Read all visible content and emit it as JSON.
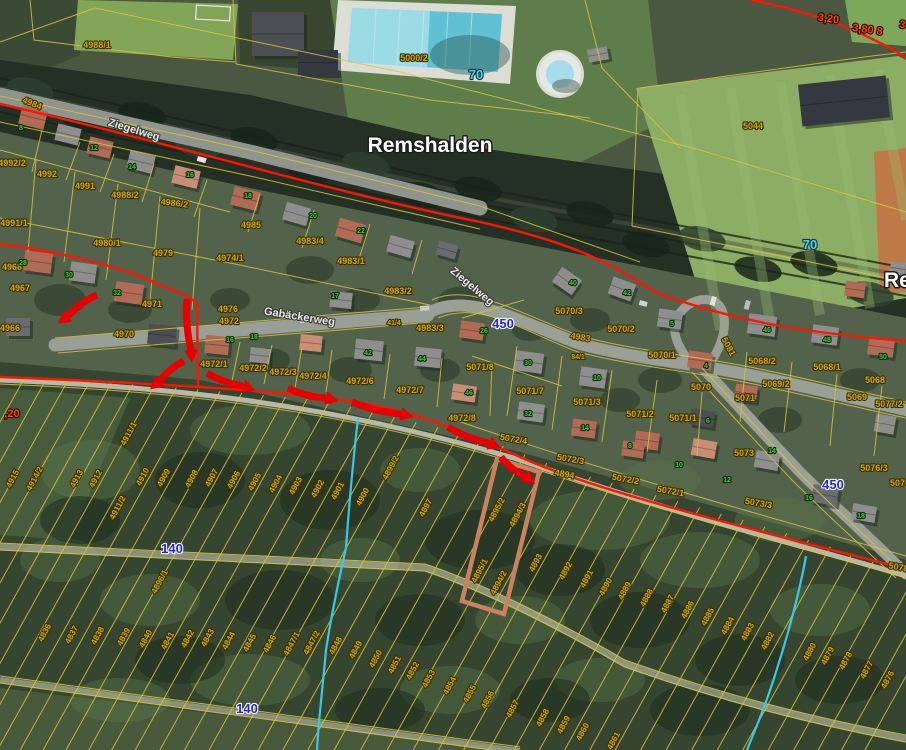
{
  "map": {
    "place_labels": [
      [
        "Remshalden",
        430,
        152,
        "middle"
      ],
      [
        "Re",
        884,
        287,
        "start"
      ]
    ],
    "street_labels": [
      [
        "Ziegelweg",
        133,
        133,
        17
      ],
      [
        "Ziegelweg",
        470,
        289,
        40
      ],
      [
        "Gabäckerweg",
        299,
        320,
        9
      ]
    ],
    "route_labels": [
      [
        "70",
        476,
        79,
        "cyan"
      ],
      [
        "70",
        810,
        249,
        "cyan"
      ],
      [
        "450",
        503,
        328,
        "blue"
      ],
      [
        "450",
        833,
        489,
        "blue"
      ],
      [
        "140",
        172,
        553,
        "blue"
      ],
      [
        "140",
        247,
        713,
        "blue"
      ]
    ],
    "measure_labels": [
      [
        "3,20",
        828,
        22,
        8
      ],
      [
        "3,80 8",
        867,
        33,
        8
      ],
      [
        "3",
        902,
        28,
        8
      ],
      [
        ",20",
        12,
        417,
        0
      ]
    ],
    "parcel_labels": [
      [
        "4988/1",
        97,
        48,
        0
      ],
      [
        "5000/2",
        414,
        61,
        0
      ],
      [
        "5044",
        753,
        129,
        0
      ],
      [
        "4984",
        31,
        106,
        22
      ],
      [
        "4992/2",
        12,
        166,
        0
      ],
      [
        "4992",
        47,
        177,
        0
      ],
      [
        "4991",
        85,
        189,
        0
      ],
      [
        "4988/2",
        125,
        198,
        0
      ],
      [
        "4986/2",
        174,
        206,
        7
      ],
      [
        "4985",
        251,
        228,
        0
      ],
      [
        "4983/4",
        310,
        244,
        0
      ],
      [
        "4983/1",
        351,
        264,
        0
      ],
      [
        "4983/2",
        398,
        294,
        0
      ],
      [
        "4983/3",
        430,
        331,
        0
      ],
      [
        "4991/1",
        14,
        226,
        0
      ],
      [
        "4980/1",
        107,
        246,
        0
      ],
      [
        "4979",
        163,
        256,
        0
      ],
      [
        "4974/1",
        230,
        261,
        0
      ],
      [
        "4968",
        12,
        270,
        0
      ],
      [
        "4967",
        20,
        291,
        0
      ],
      [
        "4966",
        10,
        331,
        0
      ],
      [
        "4971",
        152,
        307,
        0
      ],
      [
        "4970",
        124,
        337,
        0
      ],
      [
        "4976",
        228,
        312,
        0
      ],
      [
        "4972",
        229,
        324,
        0
      ],
      [
        "41/4",
        394,
        325,
        0
      ],
      [
        "4972/1",
        214,
        367,
        0
      ],
      [
        "4972/2",
        253,
        371,
        0
      ],
      [
        "4972/3",
        283,
        375,
        0
      ],
      [
        "4972/4",
        313,
        379,
        0
      ],
      [
        "4972/6",
        360,
        384,
        0
      ],
      [
        "4972/7",
        410,
        393,
        0
      ],
      [
        "4972/8",
        462,
        421,
        0
      ],
      [
        "5071/8",
        480,
        370,
        0
      ],
      [
        "5071/7",
        530,
        394,
        0
      ],
      [
        "5071/3",
        587,
        405,
        0
      ],
      [
        "5071/2",
        640,
        417,
        0
      ],
      [
        "5071/1",
        683,
        421,
        0
      ],
      [
        "5070/3",
        569,
        314,
        0
      ],
      [
        "5070/2",
        621,
        332,
        0
      ],
      [
        "5070/1",
        662,
        358,
        0
      ],
      [
        "4983",
        580,
        340,
        10
      ],
      [
        "84/1",
        578,
        359,
        0
      ],
      [
        "5070",
        701,
        390,
        0
      ],
      [
        "5071",
        745,
        401,
        0
      ],
      [
        "5081",
        726,
        348,
        62
      ],
      [
        "5068/2",
        762,
        364,
        0
      ],
      [
        "5068/1",
        827,
        370,
        0
      ],
      [
        "5068",
        875,
        383,
        0
      ],
      [
        "5069/2",
        776,
        387,
        0
      ],
      [
        "5069",
        857,
        400,
        0
      ],
      [
        "5077/2",
        889,
        407,
        0
      ],
      [
        "5076/3",
        874,
        471,
        0
      ],
      [
        "5076",
        900,
        486,
        0
      ],
      [
        "5072/4",
        513,
        442,
        10
      ],
      [
        "5072/3",
        570,
        462,
        10
      ],
      [
        "5072/2",
        625,
        482,
        10
      ],
      [
        "5072/1",
        670,
        494,
        10
      ],
      [
        "5073/3",
        758,
        506,
        10
      ],
      [
        "5073",
        744,
        456,
        0
      ],
      [
        "4894",
        564,
        477,
        10
      ],
      [
        "5078",
        898,
        570,
        10
      ],
      [
        "4915",
        15,
        480,
        -62
      ],
      [
        "4914/2",
        37,
        480,
        -62
      ],
      [
        "4913",
        79,
        480,
        -62
      ],
      [
        "4912",
        98,
        480,
        -62
      ],
      [
        "4911/1",
        131,
        435,
        -62
      ],
      [
        "4911/2",
        120,
        509,
        -62
      ],
      [
        "4910",
        145,
        478,
        -62
      ],
      [
        "4909",
        166,
        479,
        -62
      ],
      [
        "4908",
        194,
        480,
        -62
      ],
      [
        "4907",
        214,
        479,
        -62
      ],
      [
        "4906",
        236,
        481,
        -62
      ],
      [
        "4905",
        257,
        483,
        -62
      ],
      [
        "4904",
        278,
        485,
        -62
      ],
      [
        "4903",
        298,
        487,
        -62
      ],
      [
        "4902",
        320,
        490,
        -62
      ],
      [
        "4901",
        340,
        492,
        -62
      ],
      [
        "4900",
        365,
        498,
        -62
      ],
      [
        "4899/2",
        393,
        469,
        -62
      ],
      [
        "4897",
        428,
        509,
        -62
      ],
      [
        "4895/2",
        499,
        511,
        -62
      ],
      [
        "4894/3",
        520,
        516,
        -62
      ],
      [
        "4895/1",
        482,
        572,
        -62
      ],
      [
        "4894/2",
        501,
        584,
        -62
      ],
      [
        "4893",
        538,
        564,
        -62
      ],
      [
        "4892",
        568,
        572,
        -62
      ],
      [
        "4891",
        589,
        580,
        -62
      ],
      [
        "4890",
        608,
        588,
        -62
      ],
      [
        "4889",
        627,
        592,
        -62
      ],
      [
        "4888",
        649,
        599,
        -62
      ],
      [
        "4887",
        670,
        605,
        -62
      ],
      [
        "4886",
        690,
        611,
        -62
      ],
      [
        "4885",
        710,
        618,
        -62
      ],
      [
        "4884",
        730,
        627,
        -62
      ],
      [
        "4883",
        750,
        633,
        -62
      ],
      [
        "4882",
        770,
        642,
        -62
      ],
      [
        "4880",
        812,
        653,
        -62
      ],
      [
        "4879",
        830,
        657,
        -62
      ],
      [
        "4878",
        848,
        662,
        -62
      ],
      [
        "4877",
        869,
        671,
        -62
      ],
      [
        "4876",
        890,
        681,
        -62
      ],
      [
        "4896/1",
        162,
        583,
        -62
      ],
      [
        "4836",
        47,
        634,
        -62
      ],
      [
        "4837",
        74,
        636,
        -62
      ],
      [
        "4838",
        100,
        637,
        -62
      ],
      [
        "4839",
        126,
        638,
        -62
      ],
      [
        "4840",
        148,
        640,
        -62
      ],
      [
        "4841",
        170,
        642,
        -62
      ],
      [
        "4842",
        190,
        640,
        -62
      ],
      [
        "4843",
        210,
        639,
        -62
      ],
      [
        "4844",
        231,
        642,
        -62
      ],
      [
        "4845",
        252,
        644,
        -62
      ],
      [
        "4846",
        272,
        645,
        -62
      ],
      [
        "4847/1",
        294,
        645,
        -62
      ],
      [
        "4847/2",
        314,
        644,
        -62
      ],
      [
        "4848",
        338,
        647,
        -62
      ],
      [
        "4849",
        358,
        651,
        -62
      ],
      [
        "4850",
        378,
        660,
        -62
      ],
      [
        "4851",
        397,
        666,
        -62
      ],
      [
        "4852",
        415,
        672,
        -62
      ],
      [
        "4853",
        431,
        680,
        -62
      ],
      [
        "4854",
        452,
        687,
        -62
      ],
      [
        "4855",
        472,
        695,
        -62
      ],
      [
        "4856",
        490,
        701,
        -62
      ],
      [
        "4857",
        515,
        710,
        -62
      ],
      [
        "4858",
        545,
        719,
        -62
      ],
      [
        "4859",
        566,
        726,
        -62
      ],
      [
        "4860",
        585,
        733,
        -62
      ],
      [
        "4861",
        616,
        742,
        -62
      ]
    ],
    "house_numbers": [
      [
        "8",
        21,
        130
      ],
      [
        "12",
        94,
        150
      ],
      [
        "14",
        132,
        169
      ],
      [
        "16",
        190,
        177
      ],
      [
        "18",
        248,
        198
      ],
      [
        "20",
        313,
        218
      ],
      [
        "22",
        361,
        233
      ],
      [
        "28",
        23,
        265
      ],
      [
        "30",
        69,
        277
      ],
      [
        "32",
        117,
        295
      ],
      [
        "16",
        230,
        342
      ],
      [
        "18",
        254,
        339
      ],
      [
        "17",
        335,
        298
      ],
      [
        "42",
        368,
        355
      ],
      [
        "44",
        422,
        361
      ],
      [
        "40",
        573,
        285
      ],
      [
        "42",
        627,
        295
      ],
      [
        "5",
        672,
        326
      ],
      [
        "26",
        484,
        333
      ],
      [
        "30",
        528,
        365
      ],
      [
        "10",
        597,
        380
      ],
      [
        "46",
        469,
        395
      ],
      [
        "32",
        528,
        416
      ],
      [
        "14",
        585,
        430
      ],
      [
        "46",
        767,
        332
      ],
      [
        "48",
        827,
        342
      ],
      [
        "4",
        706,
        368
      ],
      [
        "50",
        883,
        359
      ],
      [
        "6",
        708,
        423
      ],
      [
        "8",
        630,
        448
      ],
      [
        "10",
        679,
        467
      ],
      [
        "12",
        727,
        482
      ],
      [
        "14",
        772,
        453
      ],
      [
        "16",
        809,
        500
      ],
      [
        "18",
        861,
        518
      ]
    ],
    "red_boundary_lines": [
      "M751,0 C800,10 840,22 870,38 C885,45 898,52 906,58",
      "M0,104 C160,140 330,192 480,222 C570,242 610,262 655,292 C740,324 820,334 906,341",
      "M0,244 C60,252 120,266 158,284 C178,293 194,297 197,305 L198,386",
      "M0,377 C150,383 250,389 320,397 C400,406 450,425 520,457 C600,493 760,531 906,569"
    ],
    "annotation_arrows": [
      [
        97,
        295,
        68,
        316
      ],
      [
        187,
        299,
        191,
        350
      ],
      [
        184,
        361,
        160,
        381
      ],
      [
        207,
        373,
        243,
        386
      ],
      [
        288,
        388,
        326,
        398
      ],
      [
        352,
        402,
        401,
        414
      ],
      [
        448,
        427,
        489,
        443
      ],
      [
        501,
        457,
        525,
        476
      ]
    ],
    "stream_lines": [
      "M358,418 C352,470 348,520 346,548 C340,575 332,610 326,650 C322,695 318,725 317,750",
      "M806,556 C800,590 788,635 776,672 C766,705 755,730 747,750"
    ],
    "highlight_parcel": {
      "points": "497,459 539,472 504,614 462,601"
    },
    "colors": {
      "parcel_line": "#d7c53a",
      "parcel_label": "#d2a90a",
      "parcel_label_halo": "#3a2f00",
      "red_line": "#ff1500",
      "arrow": "#e80000",
      "route_blue": "#2323e8",
      "route_cyan": "#49d7f0",
      "house_number": "#4ac341",
      "measure": "#ff4500",
      "stream": "#38c9e8",
      "street_label": "#e8e8e4",
      "place_label": "#ffffff",
      "highlight": "#c9825e"
    }
  }
}
